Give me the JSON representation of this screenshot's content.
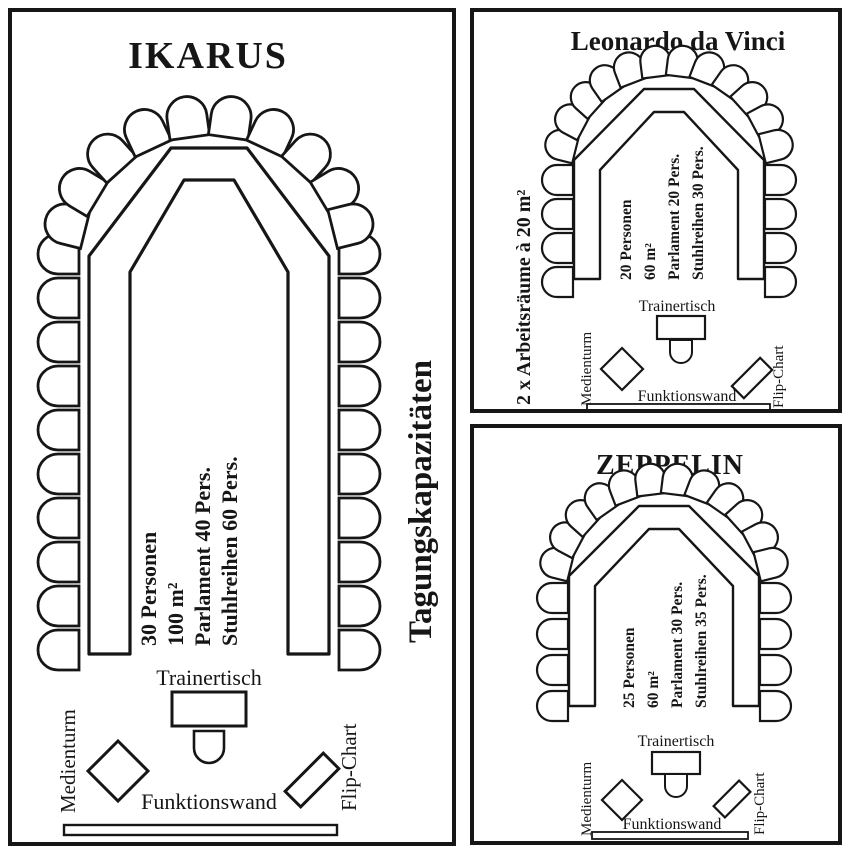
{
  "palette": {
    "ink": "#161616",
    "paper": "#ffffff"
  },
  "rooms": [
    {
      "title": "IKARUS",
      "capacity_lines": [
        "30 Personen",
        "100 m²",
        "Parlament 40 Pers.",
        "Stuhlreihen 60 Pers."
      ],
      "labels": {
        "trainer_table": "Trainertisch",
        "media_tower": "Medienturm",
        "function_wall": "Funktionswand",
        "flip_chart": "Flip-Chart"
      },
      "side_note": "Tagungskapazitäten"
    },
    {
      "title": "Leonardo da Vinci",
      "capacity_lines": [
        "20 Personen",
        "60 m²",
        "Parlament 20 Pers.",
        "Stuhlreihen 30 Pers."
      ],
      "labels": {
        "trainer_table": "Trainertisch",
        "media_tower": "Medienturm",
        "function_wall": "Funktionswand",
        "flip_chart": "Flip-Chart"
      },
      "side_note": "2 x Arbeitsräume à 20 m²"
    },
    {
      "title": "ZEPPELIN",
      "capacity_lines": [
        "25 Personen",
        "60 m²",
        "Parlament 30 Pers.",
        "Stuhlreihen 35 Pers."
      ],
      "labels": {
        "trainer_table": "Trainertisch",
        "media_tower": "Medienturm",
        "function_wall": "Funktionswand",
        "flip_chart": "Flip-Chart"
      }
    }
  ]
}
